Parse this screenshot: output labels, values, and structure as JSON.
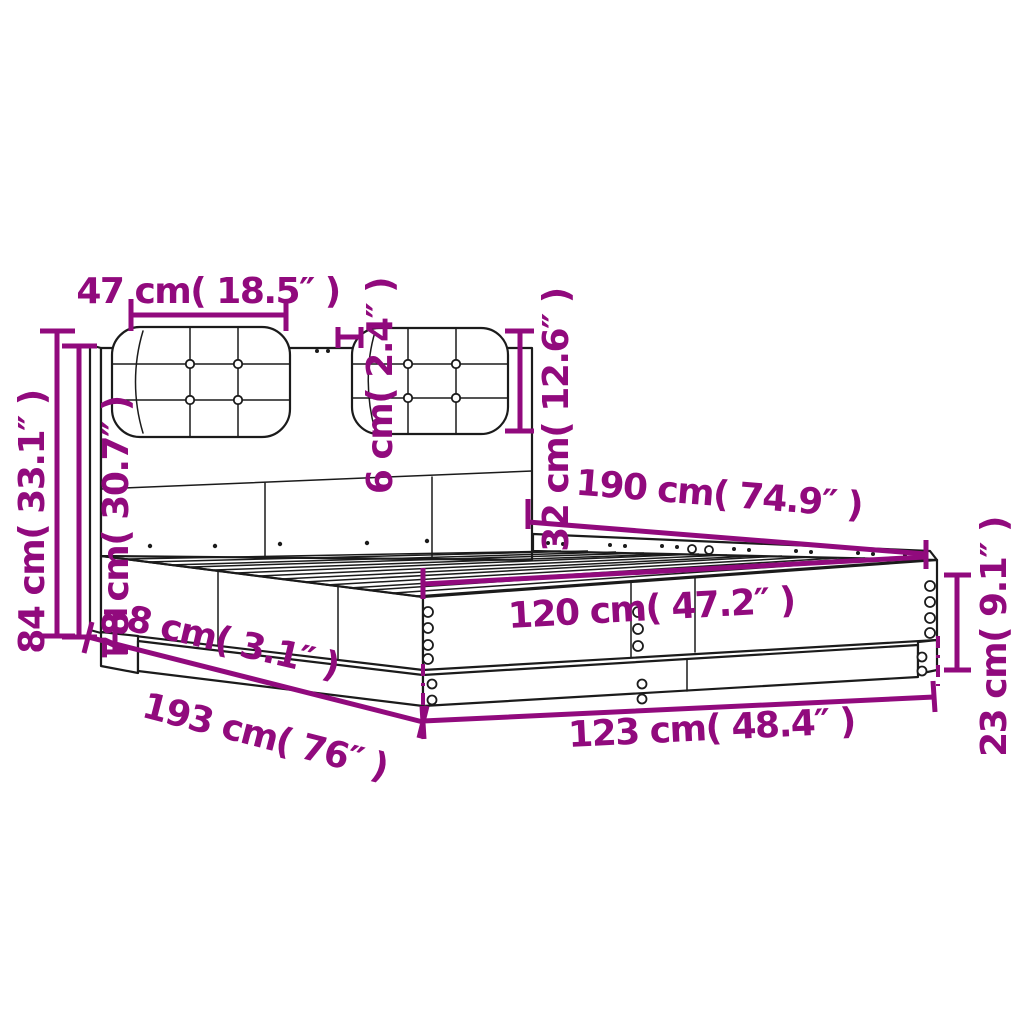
{
  "diagram": {
    "type": "furniture-dimension-diagram",
    "subject": "bed frame with headboard and two tufted cushions",
    "background_color": "#ffffff",
    "line_color": "#1b1b1b",
    "dimension_color": "#910a7d",
    "dimensions": {
      "cushion_width": "47 cm( 18.5″ )",
      "cushion_thickness": "6 cm( 2.4″ )",
      "cushion_height": "32 cm( 12.6″ )",
      "headboard_total_height": "84 cm( 33.1″ )",
      "headboard_panel_height": "78 cm( 30.7″ )",
      "bed_length": "190 cm( 74.9″ )",
      "bed_width": "120 cm( 47.2″ )",
      "plinth_height": "8 cm( 3.1″ )",
      "total_length": "193 cm( 76″ )",
      "total_width": "123 cm( 48.4″ )",
      "frame_height": "23 cm( 9.1″ )"
    }
  }
}
